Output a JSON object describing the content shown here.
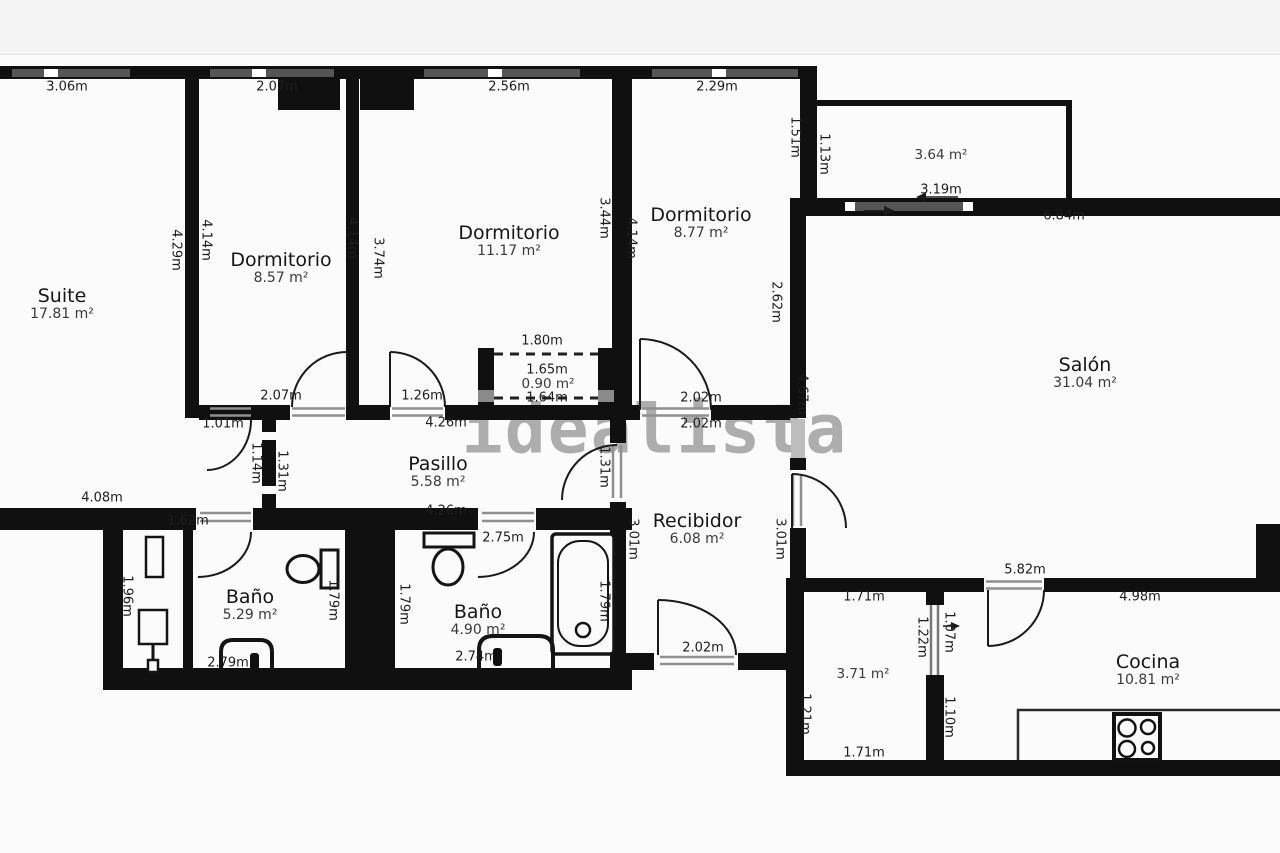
{
  "watermark_text": "idealista",
  "colors": {
    "wall": "#101010",
    "background": "#fbfbfb",
    "top_strip": "#f4f4f4",
    "watermark": "#a0a0a0",
    "window": "#555555",
    "threshold": "#8f8f8f",
    "dim_text": "#1d1d1d",
    "room_name_text": "#161616",
    "area_text": "#3a3a3a"
  },
  "rooms": [
    {
      "name": "Suite",
      "area": "17.81 m²",
      "x": 62,
      "y": 296
    },
    {
      "name": "Dormitorio",
      "area": "8.57 m²",
      "x": 281,
      "y": 260
    },
    {
      "name": "Dormitorio",
      "area": "11.17 m²",
      "x": 509,
      "y": 233
    },
    {
      "name": "Dormitorio",
      "area": "8.77 m²",
      "x": 701,
      "y": 215
    },
    {
      "name": "Salón",
      "area": "31.04 m²",
      "x": 1085,
      "y": 365
    },
    {
      "name": "Pasillo",
      "area": "5.58 m²",
      "x": 438,
      "y": 464
    },
    {
      "name": "Recibidor",
      "area": "6.08 m²",
      "x": 697,
      "y": 521
    },
    {
      "name": "Baño",
      "area": "5.29 m²",
      "x": 250,
      "y": 597
    },
    {
      "name": "Baño",
      "area": "4.90 m²",
      "x": 478,
      "y": 612
    },
    {
      "name": "Cocina",
      "area": "10.81 m²",
      "x": 1148,
      "y": 662
    }
  ],
  "standalone_areas": [
    {
      "text": "3.64 m²",
      "x": 941,
      "y": 155
    },
    {
      "text": "0.90 m²",
      "x": 548,
      "y": 384
    },
    {
      "text": "3.71 m²",
      "x": 863,
      "y": 674
    }
  ],
  "h_dims": [
    {
      "text": "3.06m",
      "x": 67,
      "y": 87
    },
    {
      "text": "2.07m",
      "x": 277,
      "y": 87
    },
    {
      "text": "2.56m",
      "x": 509,
      "y": 87
    },
    {
      "text": "2.29m",
      "x": 717,
      "y": 87
    },
    {
      "text": "3.19m",
      "x": 941,
      "y": 190
    },
    {
      "text": "6.84m",
      "x": 1064,
      "y": 216
    },
    {
      "text": "1.80m",
      "x": 542,
      "y": 341
    },
    {
      "text": "1.65m",
      "x": 547,
      "y": 370
    },
    {
      "text": "1.64m",
      "x": 547,
      "y": 398
    },
    {
      "text": "2.07m",
      "x": 281,
      "y": 396
    },
    {
      "text": "1.26m",
      "x": 422,
      "y": 396
    },
    {
      "text": "4.26m",
      "x": 446,
      "y": 423
    },
    {
      "text": "2.02m",
      "x": 701,
      "y": 398
    },
    {
      "text": "2.02m",
      "x": 701,
      "y": 424
    },
    {
      "text": "1.01m",
      "x": 223,
      "y": 424
    },
    {
      "text": "4.26m",
      "x": 446,
      "y": 511
    },
    {
      "text": "4.08m",
      "x": 102,
      "y": 498
    },
    {
      "text": "1.62m",
      "x": 188,
      "y": 521
    },
    {
      "text": "2.75m",
      "x": 503,
      "y": 538
    },
    {
      "text": "5.82m",
      "x": 1025,
      "y": 570
    },
    {
      "text": "1.71m",
      "x": 864,
      "y": 597
    },
    {
      "text": "4.98m",
      "x": 1140,
      "y": 597
    },
    {
      "text": "2.79m",
      "x": 228,
      "y": 663
    },
    {
      "text": "2.74m",
      "x": 476,
      "y": 657
    },
    {
      "text": "2.02m",
      "x": 703,
      "y": 648
    },
    {
      "text": "1.71m",
      "x": 864,
      "y": 753
    },
    {
      "text": "4.98m",
      "x": 1138,
      "y": 753
    }
  ],
  "v_dims": [
    {
      "text": "4.29m",
      "x": 176,
      "y": 250
    },
    {
      "text": "4.14m",
      "x": 206,
      "y": 240
    },
    {
      "text": "4.14m",
      "x": 352,
      "y": 238
    },
    {
      "text": "3.74m",
      "x": 378,
      "y": 258
    },
    {
      "text": "3.44m",
      "x": 604,
      "y": 218
    },
    {
      "text": "4.14m",
      "x": 631,
      "y": 238
    },
    {
      "text": "1.51m",
      "x": 795,
      "y": 137
    },
    {
      "text": "1.13m",
      "x": 824,
      "y": 154
    },
    {
      "text": "2.62m",
      "x": 776,
      "y": 302
    },
    {
      "text": "4.67m",
      "x": 802,
      "y": 394
    },
    {
      "text": "1.14m",
      "x": 256,
      "y": 463
    },
    {
      "text": "1.31m",
      "x": 282,
      "y": 471
    },
    {
      "text": "1.31m",
      "x": 604,
      "y": 467
    },
    {
      "text": "3.01m",
      "x": 633,
      "y": 539
    },
    {
      "text": "3.01m",
      "x": 780,
      "y": 539
    },
    {
      "text": "1.96m",
      "x": 127,
      "y": 596
    },
    {
      "text": "1.79m",
      "x": 333,
      "y": 600
    },
    {
      "text": "1.79m",
      "x": 404,
      "y": 604
    },
    {
      "text": "1.79m",
      "x": 604,
      "y": 601
    },
    {
      "text": "1.21m",
      "x": 805,
      "y": 714
    },
    {
      "text": "1.22m",
      "x": 922,
      "y": 637
    },
    {
      "text": "1.07m",
      "x": 949,
      "y": 632
    },
    {
      "text": "1.10m",
      "x": 949,
      "y": 717
    }
  ]
}
